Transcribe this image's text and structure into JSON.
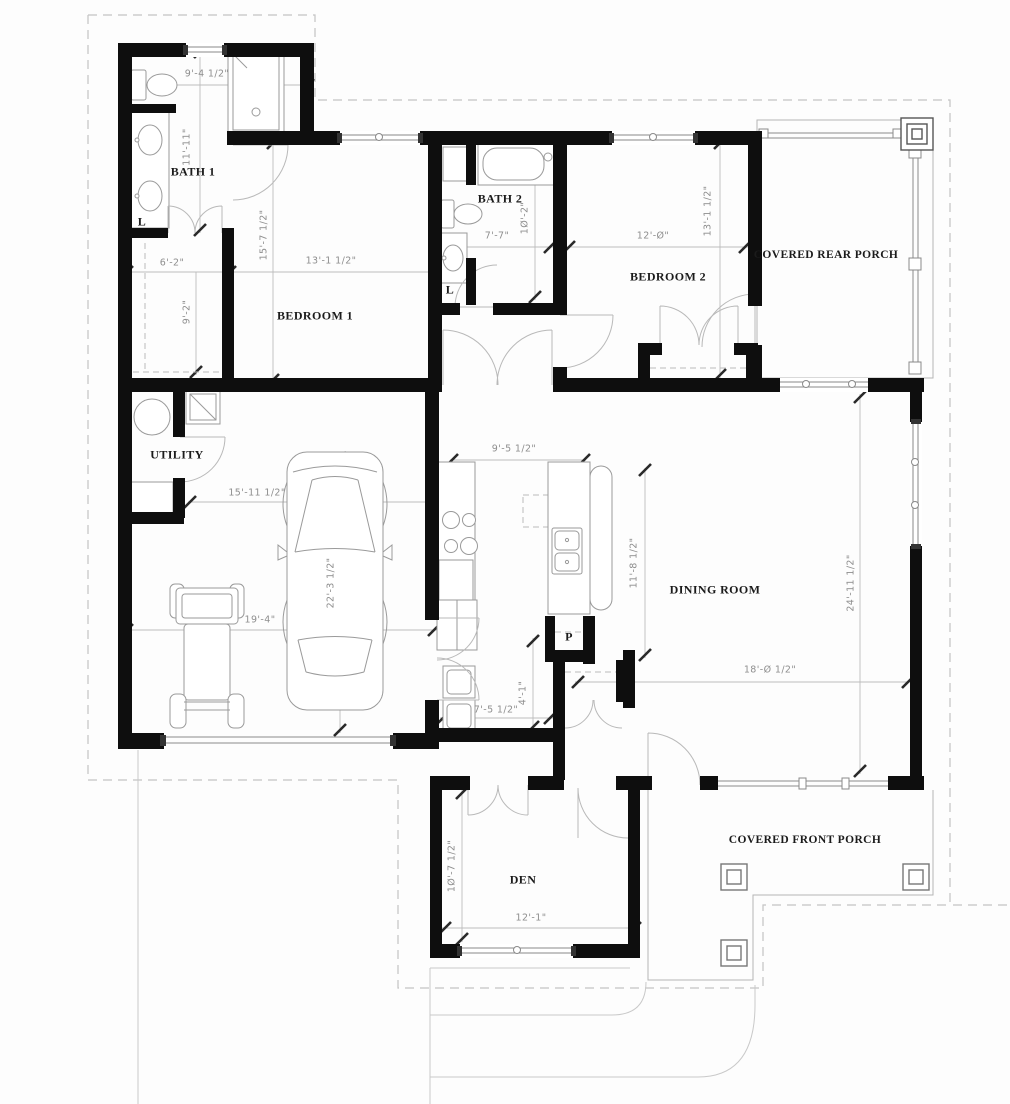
{
  "rooms": {
    "bath1": "BATH 1",
    "bedroom1": "BEDROOM 1",
    "bath2": "BATH 2",
    "bedroom2": "BEDROOM 2",
    "rear_porch": "COVERED REAR PORCH",
    "utility": "UTILITY",
    "dining": "DINING ROOM",
    "den": "DEN",
    "front_porch": "COVERED FRONT PORCH"
  },
  "closets": {
    "linen_bath1": "L",
    "linen_hall": "L",
    "pantry": "P"
  },
  "dimensions": {
    "bath1_width": "9'-4 1/2\"",
    "bath1_length": "11'-11\"",
    "bedroom1_length": "15'-7 1/2\"",
    "bedroom1_width": "13'-1 1/2\"",
    "closet_width": "6'-2\"",
    "closet_length": "9'-2\"",
    "bath2_width": "7'-7\"",
    "bath2_length": "1Ø'-2\"",
    "bedroom2_width": "12'-Ø\"",
    "bedroom2_length": "13'-1 1/2\"",
    "garage_width_upper": "15'-11 1/2\"",
    "garage_width": "19'-4\"",
    "garage_length": "22'-3 1/2\"",
    "kitchen_width": "9'-5 1/2\"",
    "kitchen_length": "11'-8 1/2\"",
    "dining_width": "18'-Ø 1/2\"",
    "dining_length": "24'-11 1/2\"",
    "den_length": "1Ø'-7 1/2\"",
    "den_width": "12'-1\"",
    "mud_width": "7'-5 1/2\"",
    "mud_length": "4'-1\""
  }
}
